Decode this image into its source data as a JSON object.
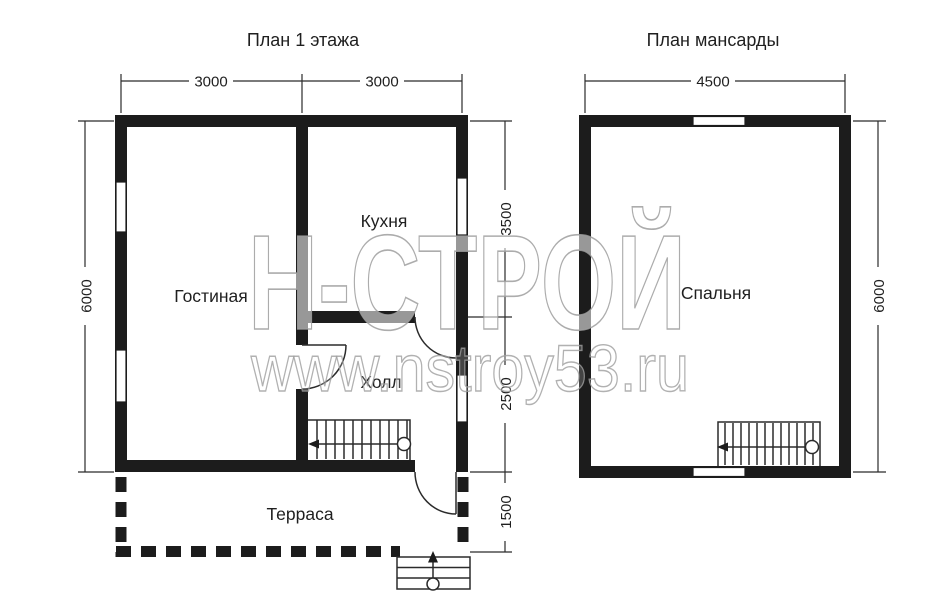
{
  "titles": {
    "floor1": "План 1 этажа",
    "attic": "План мансарды"
  },
  "floor1": {
    "rooms": {
      "living": "Гостиная",
      "kitchen": "Кухня",
      "hall": "Холл",
      "terrace": "Терраса"
    },
    "dims": {
      "top_left": "3000",
      "top_right": "3000",
      "left": "6000",
      "kitchen_depth": "3500",
      "hall_depth": "2500",
      "terrace_depth": "1500"
    }
  },
  "attic": {
    "rooms": {
      "bedroom": "Спальня"
    },
    "dims": {
      "top": "4500",
      "right": "6000"
    }
  },
  "watermark": {
    "brand": "Н-СТРОЙ",
    "site": "www.nstroy53.ru"
  },
  "colors": {
    "wall": "#1c1c1c",
    "line": "#2b2b2b",
    "text": "#1f1f1f",
    "watermark_stroke": "#9e9e9e",
    "background": "#ffffff"
  }
}
